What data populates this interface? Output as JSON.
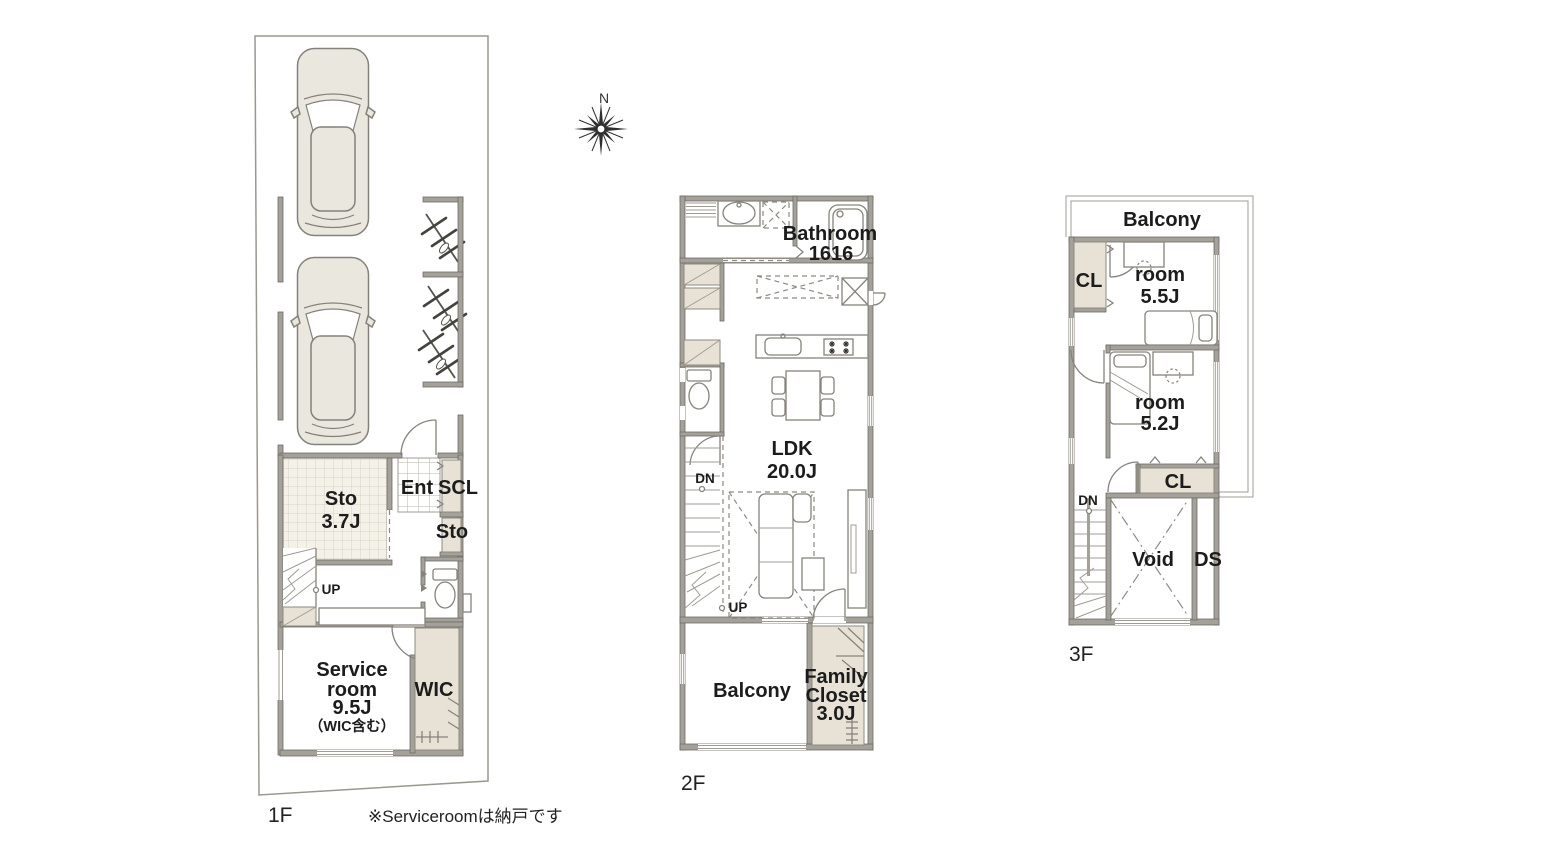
{
  "palette": {
    "wall": "#a4a19b",
    "wall_outline": "#6e6b65",
    "storage_beige": "#e8e2d6",
    "tile_floor": "#f4f1e8",
    "tile_grid": "#d8d3c5",
    "line": "#87837c",
    "text": "#1c1c1c",
    "car_fill": "#e9e7de",
    "background": "#ffffff"
  },
  "compass": {
    "north_label": "N"
  },
  "note": "※Serviceroomは納戸です",
  "floors": {
    "f1": {
      "label": "1F",
      "rooms": {
        "sto": {
          "lines": [
            "Sto",
            "3.7J"
          ]
        },
        "ent": "Ent",
        "scl": "SCL",
        "sto2": "Sto",
        "up": "UP",
        "service": {
          "lines": [
            "Service",
            "room",
            "9.5J",
            "（WIC含む）"
          ]
        },
        "wic": "WIC"
      }
    },
    "f2": {
      "label": "2F",
      "rooms": {
        "bathroom": {
          "lines": [
            "Bathroom",
            "1616"
          ]
        },
        "ldk": {
          "lines": [
            "LDK",
            "20.0J"
          ]
        },
        "dn": "DN",
        "up": "UP",
        "balcony": "Balcony",
        "family_closet": {
          "lines": [
            "Family",
            "Closet",
            "3.0J"
          ]
        }
      }
    },
    "f3": {
      "label": "3F",
      "rooms": {
        "balcony": "Balcony",
        "cl1": "CL",
        "room1": {
          "lines": [
            "room",
            "5.5J"
          ]
        },
        "room2": {
          "lines": [
            "room",
            "5.2J"
          ]
        },
        "cl2": "CL",
        "dn": "DN",
        "void": "Void",
        "ds": "DS"
      }
    }
  }
}
